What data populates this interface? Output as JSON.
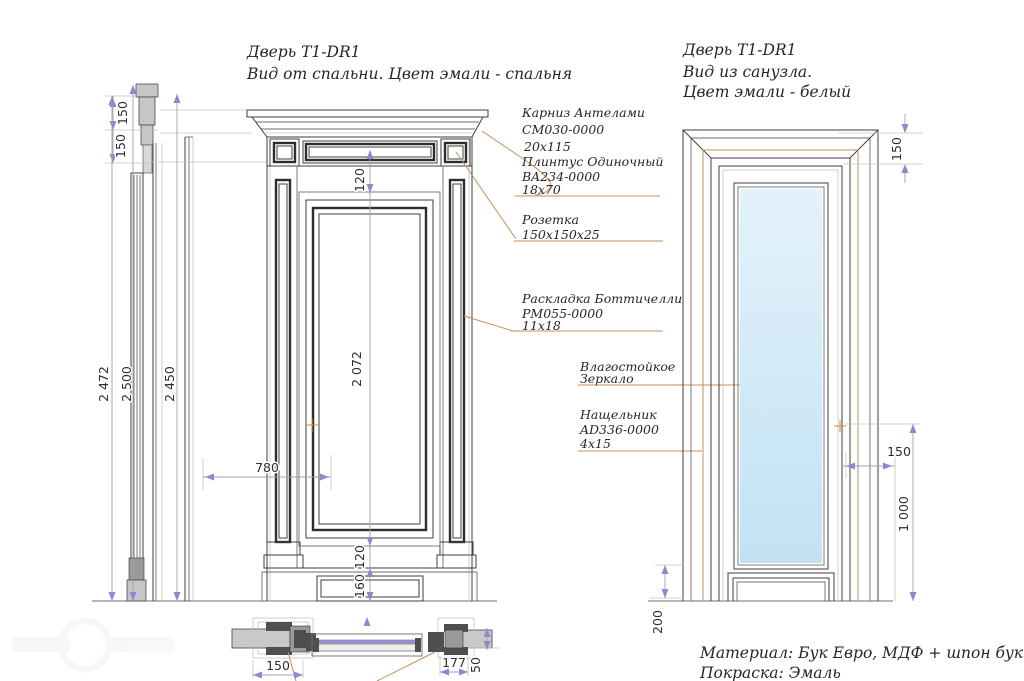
{
  "drawing": {
    "title_front": {
      "line1": "Дверь T1-DR1",
      "line2": "Вид от спальни. Цвет эмали - спальня"
    },
    "title_mirror": {
      "line1": "Дверь T1-DR1",
      "line2": "Вид из санузла.",
      "line3": "Цвет эмали - белый"
    },
    "footer": {
      "material": "Материал: Бук Евро, МДФ + шпон бук",
      "paint": "Покраска: Эмаль"
    },
    "annotations": {
      "karniz": {
        "name": "Карниз Антелами",
        "code": "CM030-0000",
        "size": "20x115"
      },
      "plintus": {
        "name": "Плинтус Одиночный",
        "code": "BA234-0000",
        "size": "18x70"
      },
      "rozetka": {
        "name": "Розетка",
        "size": "150x150x25"
      },
      "raskladka": {
        "name": "Раскладка Боттичелли",
        "code": "PM055-0000",
        "size": "11x18"
      },
      "zerkalo": {
        "line1": "Влагостойкое",
        "line2": "Зеркало"
      },
      "nashchelnik": {
        "name": "Нащельник",
        "code": "AD336-0000",
        "size": "4x15"
      }
    },
    "dims": {
      "side": {
        "crown_top": "150",
        "crown_bottom": "150",
        "total": "2 472",
        "overall": "2 500",
        "opening": "2 450"
      },
      "front": {
        "frieze": "120",
        "leaf_height": "2 072",
        "leaf_width": "780",
        "panel_bottom": "120",
        "plinth": "160"
      },
      "mirror": {
        "head": "150",
        "casing": "150",
        "mirror_height": "1 000",
        "plinth": "200"
      },
      "plan": {
        "casing_left": "150",
        "casing_right": "177",
        "jamb_depth": "50"
      }
    },
    "colors": {
      "leader": "#c0905a",
      "dimension_arrow": "#8a8ad0",
      "mirror_fill": "#cfe7f6",
      "line": "#3f3f3f"
    }
  }
}
